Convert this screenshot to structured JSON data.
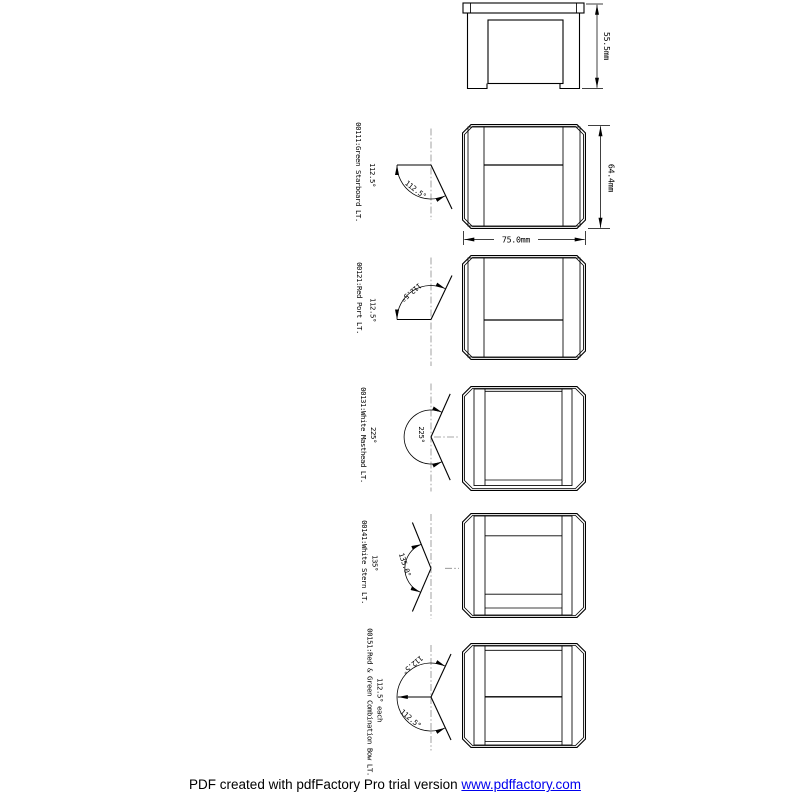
{
  "front": {
    "height_dim": "55.5mm"
  },
  "views": {
    "starboard": {
      "id": "00111:Green Starboard LT.",
      "angle": "112.5°",
      "arc_label": "112.5°",
      "height_dim": "64.4mm",
      "width_dim": "75.0mm"
    },
    "port": {
      "id": "00121:Red Port LT.",
      "angle": "112.5°",
      "arc_label": "112.5°"
    },
    "masthead": {
      "id": "00131:White Masthead LT.",
      "angle": "225°",
      "arc_label": "225°"
    },
    "stern": {
      "id": "00141:White Stern LT.",
      "angle": "135°",
      "arc_label": "135.0°"
    },
    "combination": {
      "id": "00151:Red & Green Combination Bow LT.",
      "angle": "112.5° each",
      "arc_label_upper": "112.5°",
      "arc_label_lower": "112.5°"
    }
  },
  "footer": {
    "text": "PDF created with pdfFactory Pro trial version ",
    "link_text": "www.pdffactory.com"
  },
  "colors": {
    "line": "#000000",
    "centerline": "#8a8a8a",
    "link": "#0000ee",
    "background": "#ffffff"
  }
}
